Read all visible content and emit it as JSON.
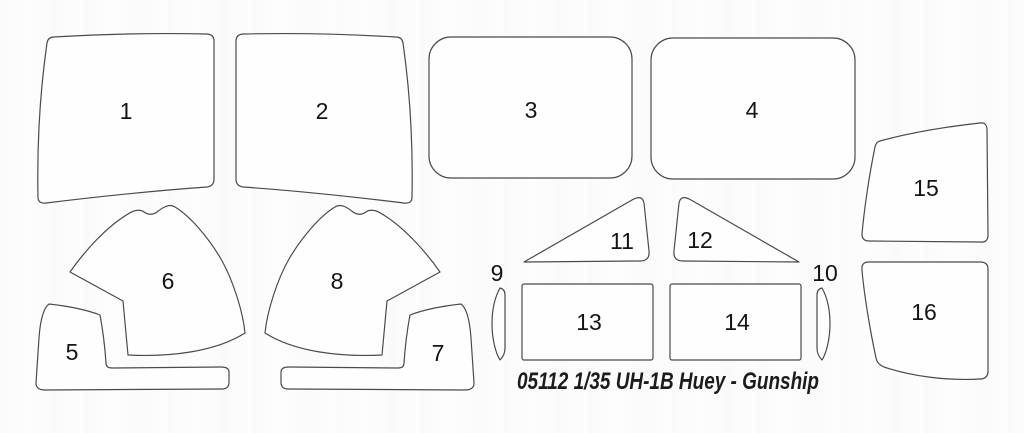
{
  "title": "05112 1/35 UH-1B Huey - Gunship",
  "parts": [
    {
      "label": "1"
    },
    {
      "label": "2"
    },
    {
      "label": "3"
    },
    {
      "label": "4"
    },
    {
      "label": "5"
    },
    {
      "label": "6"
    },
    {
      "label": "7"
    },
    {
      "label": "8"
    },
    {
      "label": "9"
    },
    {
      "label": "10"
    },
    {
      "label": "11"
    },
    {
      "label": "12"
    },
    {
      "label": "13"
    },
    {
      "label": "14"
    },
    {
      "label": "15"
    },
    {
      "label": "16"
    }
  ],
  "colors": {
    "background": "#fdfdfd",
    "part_fill": "#fefefe",
    "outline": "#4a4a4a",
    "label_text": "#141414",
    "title_text": "#1c1c1c"
  }
}
